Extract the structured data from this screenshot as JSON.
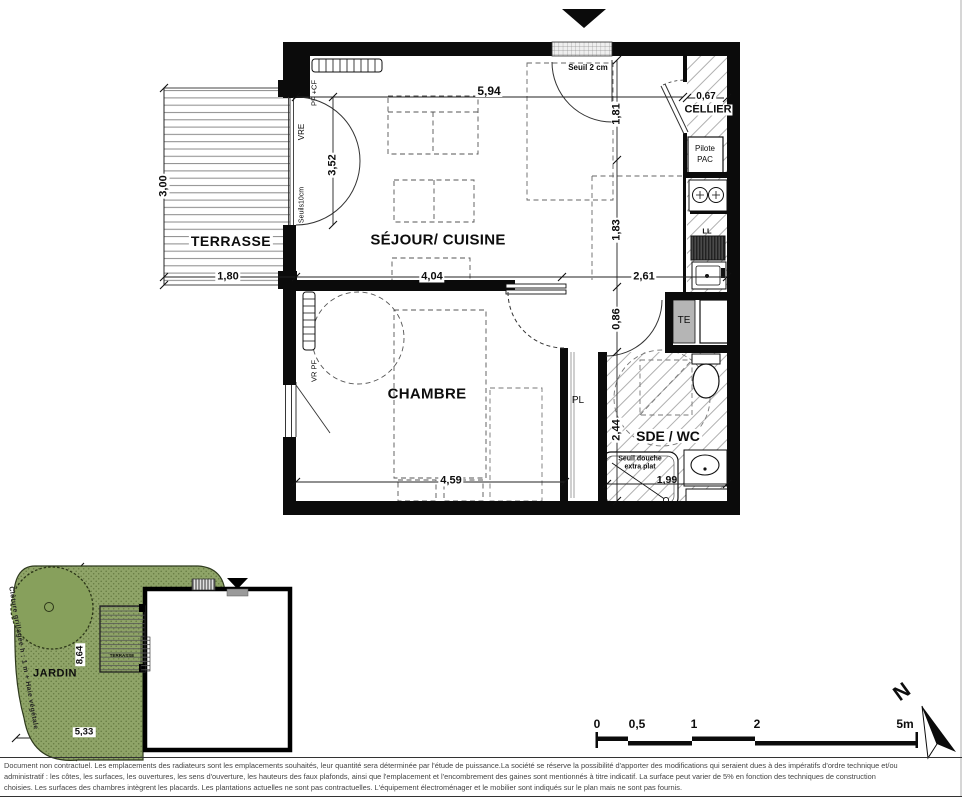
{
  "rooms": {
    "terrasse": "TERRASSE",
    "sejour": "SÉJOUR/ CUISINE",
    "chambre": "CHAMBRE",
    "sde": "SDE / WC",
    "cellier": "CELLIER"
  },
  "dimensions": {
    "sejour_width": "5,94",
    "terrasse_height": "3,00",
    "terrasse_width": "1,80",
    "bay_height": "3,52",
    "entry_depth": "1,81",
    "kitchen_depth": "1,83",
    "sejour_left": "4,04",
    "sejour_right": "2,61",
    "cellier_width": "0,67",
    "hall_width": "0,86",
    "sde_height": "2,44",
    "chambre_width": "4,59",
    "sde_width": "1,99"
  },
  "annotations": {
    "entry_threshold": "Seuil 2 cm",
    "shower_note": "Seuil douche extra plat",
    "pilote_pac": "Pilote\nPAC",
    "te": "TE",
    "ll": "LL",
    "pl": "PL",
    "vre": "VRE",
    "seuils": "Seuils10cm",
    "pf_cf": "PF +CF",
    "vr_pf": "VR PF"
  },
  "site_plan": {
    "jardin": "JARDIN",
    "terrasse_small": "TERRASSE",
    "fence_note": "Clôture grillagée h : 1 m + Haie végétale",
    "garden_height": "8,64",
    "garden_width": "5,33"
  },
  "scale_bar": {
    "ticks": [
      "0",
      "0,5",
      "1",
      "2",
      "5m"
    ]
  },
  "north_label": "N",
  "disclaimer": {
    "line1": "Document non contractuel. Les emplacements des radiateurs sont les emplacements souhaités, leur quantité sera déterminée par l'étude de puissance.La société se réserve la possibilité d'apporter des modifications qui seraient dues à des impératifs d'ordre technique et/ou",
    "line2": "administratif : les côtes, les surfaces, les ouvertures, les sens d'ouverture, les hauteurs des faux plafonds, ainsi que l'emplacement et l'encombrement des gaines sont mentionnés à titre indicatif. La surface peut varier de 5% en fonction des techniques de construction",
    "line3": "choisies. Les surfaces des chambres intègrent les placards. Les plantations actuelles ne sont pas contractuelles. L'équipement électroménager et le mobilier sont indiqués sur le plan mais ne sont pas fournis."
  },
  "colors": {
    "wall": "#0b0b0b",
    "garden_green": "#8fa468",
    "hatch_grey": "#b0b0b0"
  }
}
